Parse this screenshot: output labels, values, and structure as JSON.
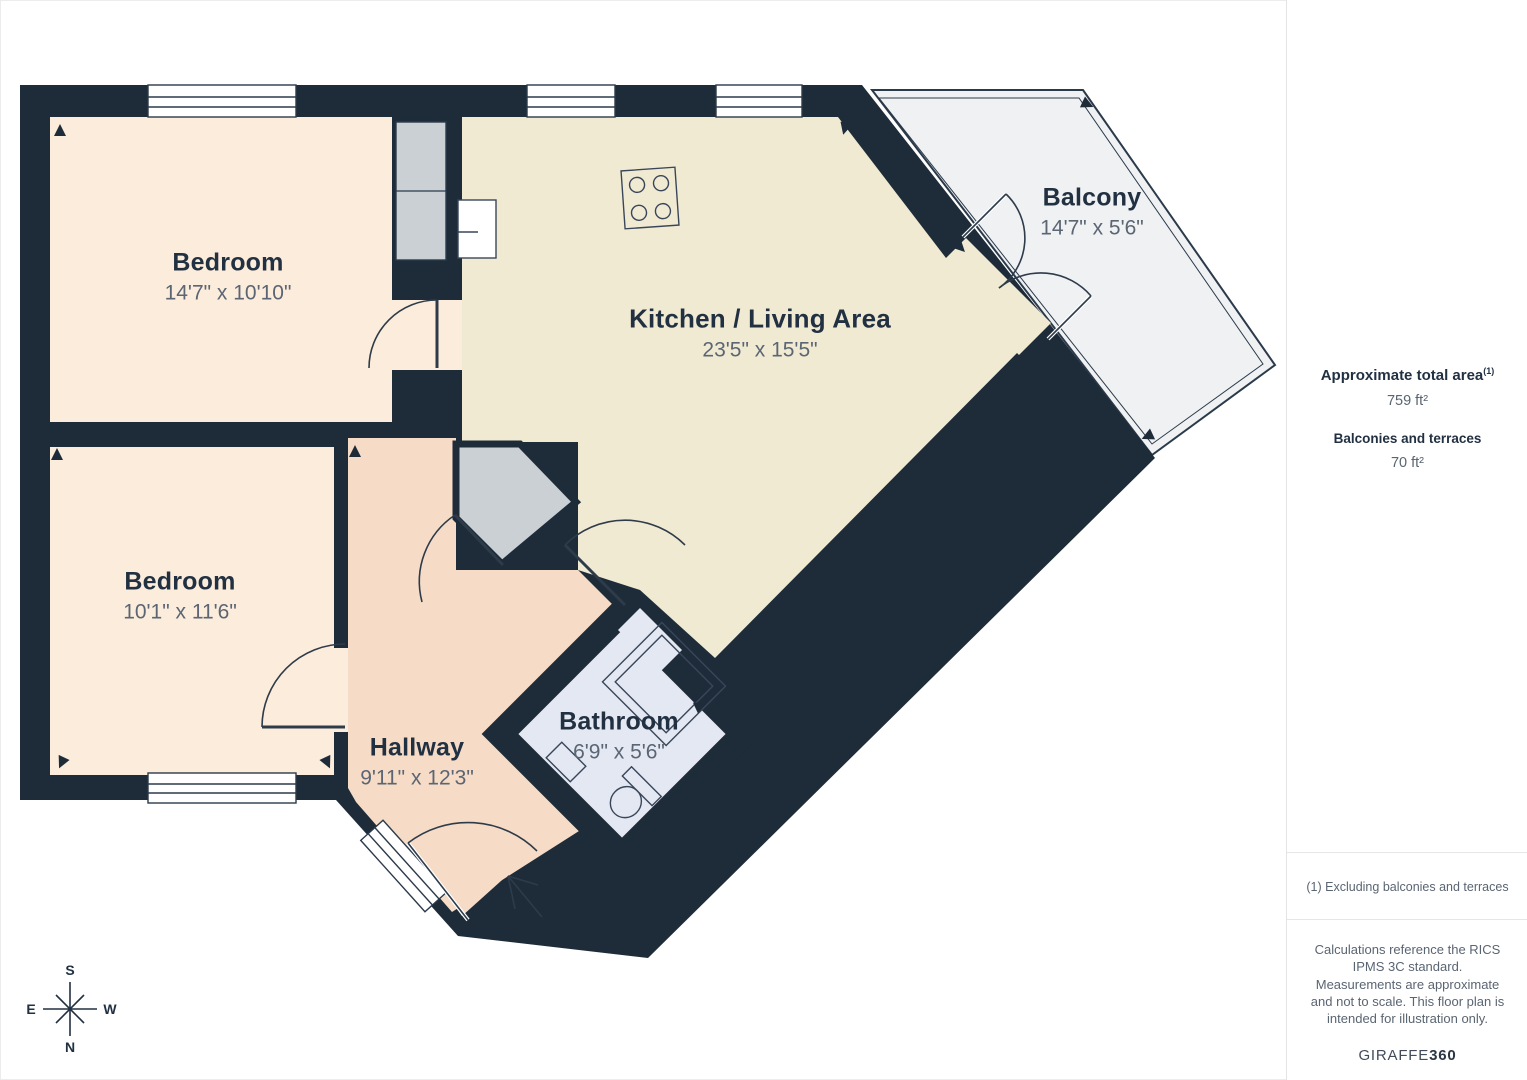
{
  "plan": {
    "rooms": [
      {
        "name": "Bedroom",
        "dims": "14'7\" x 10'10\""
      },
      {
        "name": "Bedroom",
        "dims": "10'1\" x 11'6\""
      },
      {
        "name": "Kitchen / Living Area",
        "dims": "23'5\" x 15'5\""
      },
      {
        "name": "Balcony",
        "dims": "14'7\" x 5'6\""
      },
      {
        "name": "Hallway",
        "dims": "9'11\" x 12'3\""
      },
      {
        "name": "Bathroom",
        "dims": "6'9\" x 5'6\""
      }
    ],
    "compass": {
      "n": "N",
      "s": "S",
      "e": "E",
      "w": "W"
    }
  },
  "sidebar": {
    "total_area_label": "Approximate total area",
    "total_area_superscript": "(1)",
    "total_area_value": "759 ft²",
    "balconies_label": "Balconies and terraces",
    "balconies_value": "70 ft²",
    "footnote": "(1) Excluding balconies and terraces",
    "disclaimer": "Calculations reference the RICS IPMS 3C standard. Measurements are approximate and not to scale. This floor plan is intended for illustration only.",
    "brand_name": "GIRAFFE",
    "brand_number": "360"
  },
  "colors": {
    "wall": "#1e2c3a",
    "bedroom_fill": "#fcecdb",
    "kitchen_fill": "#f0ead3",
    "hallway_fill": "#f6dcc7",
    "bathroom_fill": "#e4e8f2",
    "balcony_fill": "#eff1f3",
    "closet_fill": "#cbd0d4",
    "accent_text": "#223142",
    "muted_text": "#5b6573"
  }
}
